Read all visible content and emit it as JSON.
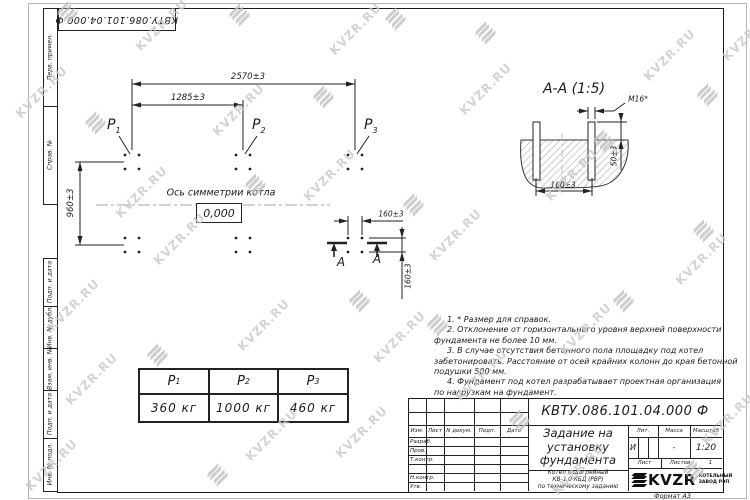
{
  "doc_number": "КВТУ.086.101.04.000  Ф",
  "watermark": {
    "text": "KVZR.RU"
  },
  "margin_fields": {
    "items": [
      "Перв. примен.",
      "Справ. №",
      "Подп. и дата",
      "Инв. № дубл.",
      "Взам. инв. №",
      "Подп. и дата",
      "Инв. № подл."
    ]
  },
  "plan": {
    "dim_overall": "2570±3",
    "dim_half": "1285±3",
    "dim_vertical": "960±3",
    "dim_bolt_spacing_h": "160±3",
    "dim_bolt_spacing_v": "160±3",
    "points": [
      {
        "base": "P",
        "sub": "1"
      },
      {
        "base": "P",
        "sub": "2"
      },
      {
        "base": "P",
        "sub": "3"
      }
    ],
    "axis_label": "Ось симметрии котла",
    "level_mark": "0,000",
    "section_letter": "А"
  },
  "section_view": {
    "title": "А-А (1:5)",
    "bolt_thread": "М16*",
    "dim_spacing": "160±3",
    "dim_protrusion": "50±3"
  },
  "notes": {
    "lines": [
      "1. * Размер для справок.",
      "2. Отклонение от горизонтального уровня верхней поверхности",
      "фундамента не более 10 мм.",
      "3. В случае отсутствия бетонного пола площадку под котел",
      "забетонировать. Расстояние от осей крайних колонн до края бетонной",
      "подушки 500 мм.",
      "4. Фундамент под котел разрабатывает проектная организация",
      "по нагрузкам на фундамент."
    ]
  },
  "load_table": {
    "headers": [
      {
        "base": "P",
        "sub": "1"
      },
      {
        "base": "P",
        "sub": "2"
      },
      {
        "base": "P",
        "sub": "3"
      }
    ],
    "values": [
      "360 кг",
      "1000 кг",
      "460 кг"
    ]
  },
  "title_block": {
    "title_lines": [
      "Задание на",
      "установку",
      "фундамента"
    ],
    "subtitle_lines": [
      "Котел водогрейный",
      "КВ-1,0 КБД (РВР)",
      "по техническому заданию"
    ],
    "header_cols": [
      "Изм.",
      "Лист",
      "N докум.",
      "Подп.",
      "Дата"
    ],
    "rows": [
      "Разраб.",
      "Пров.",
      "Т.контр.",
      "",
      "Н.контр.",
      "Утв."
    ],
    "lit_header": "Лит.",
    "lit_value": "И",
    "mass_header": "Масса",
    "mass_value": "-",
    "scale_header": "Масштаб",
    "scale_value": "1:20",
    "sheet_label": "Лист",
    "sheets_label": "Листов",
    "sheets_value": "1",
    "logo_text": "KVZR",
    "logo_caption_lines": [
      "КОТЕЛЬНЫЙ",
      "ЗАВОД РЭП"
    ],
    "format_label": "Формат А3"
  }
}
